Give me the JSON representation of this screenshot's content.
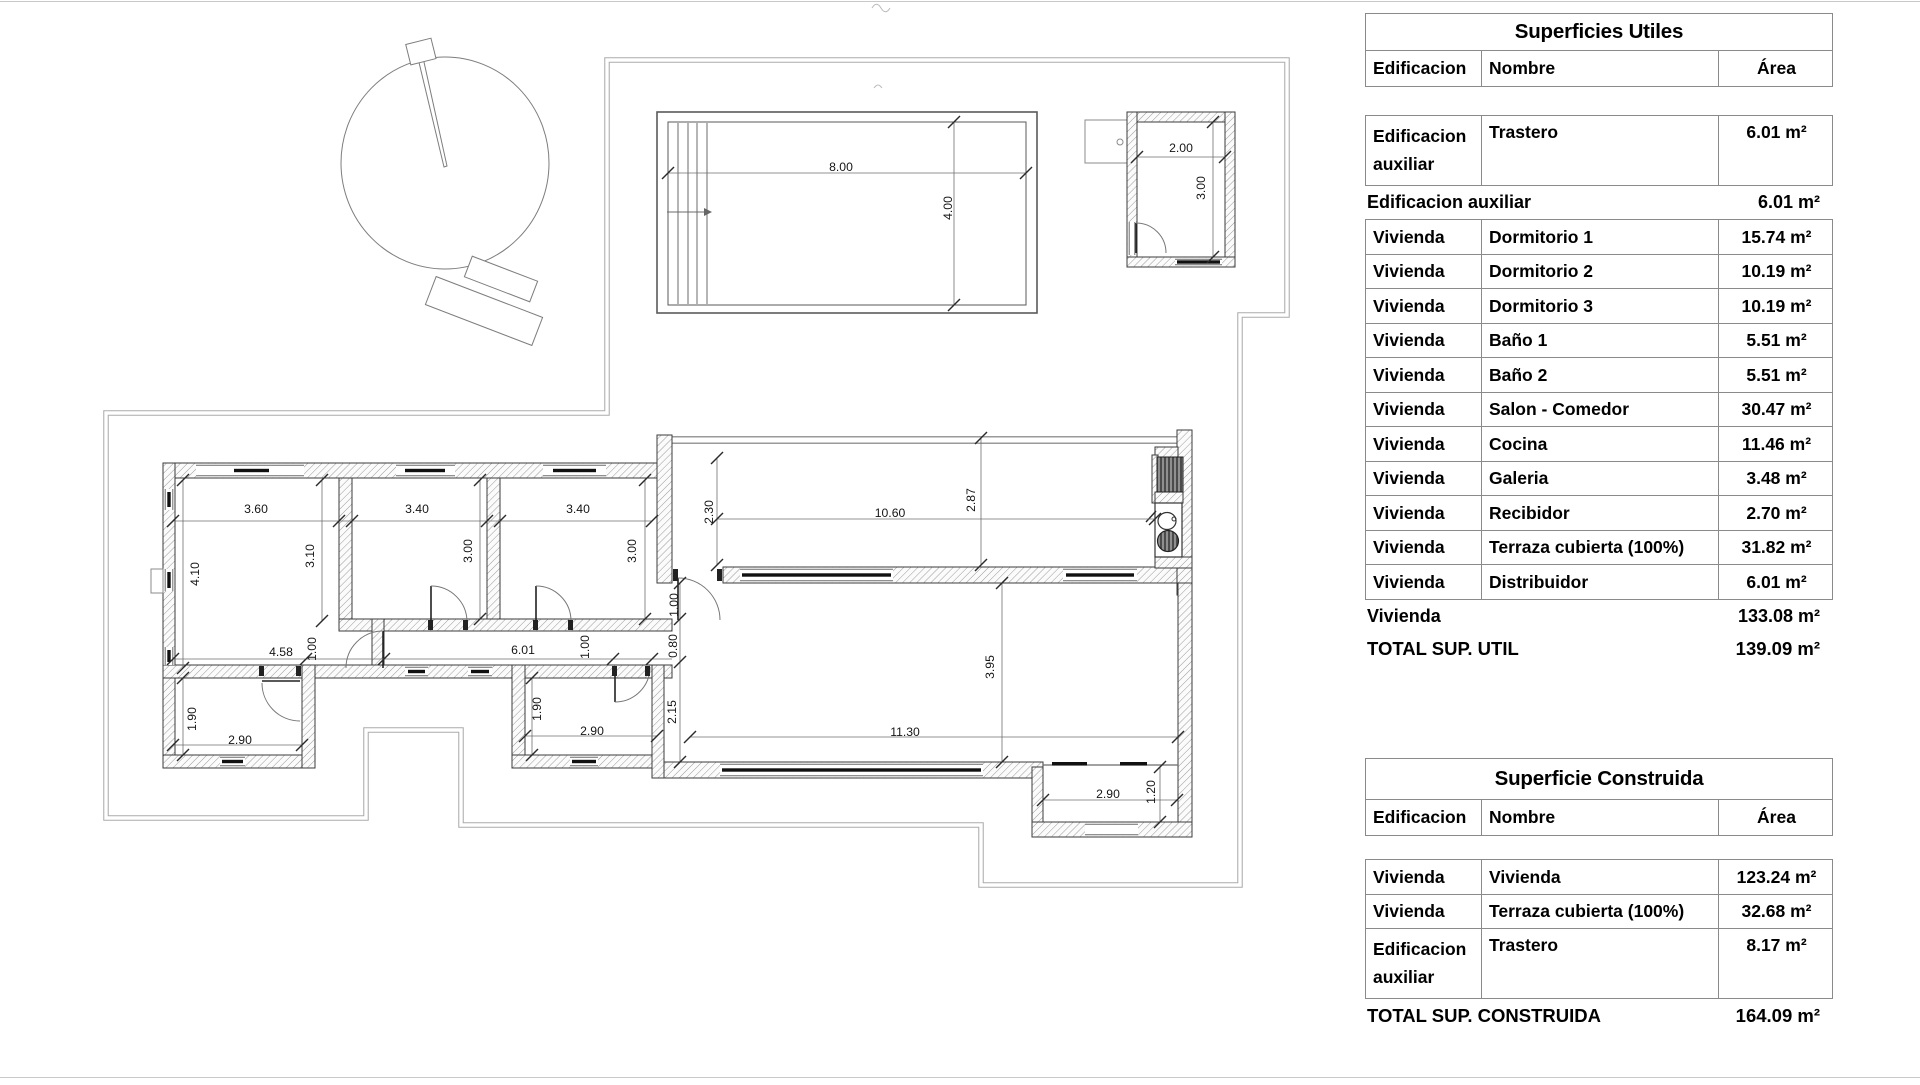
{
  "plan": {
    "dimensions": [
      {
        "text": "8.00",
        "x": 841,
        "y": 167
      },
      {
        "text": "4.00",
        "x": 948,
        "y": 208,
        "rot": true
      },
      {
        "text": "2.00",
        "x": 1181,
        "y": 148
      },
      {
        "text": "3.00",
        "x": 1201,
        "y": 188,
        "rot": true
      },
      {
        "text": "3.60",
        "x": 256,
        "y": 509
      },
      {
        "text": "3.40",
        "x": 417,
        "y": 509
      },
      {
        "text": "3.40",
        "x": 578,
        "y": 509
      },
      {
        "text": "4.10",
        "x": 195,
        "y": 574,
        "rot": true
      },
      {
        "text": "3.10",
        "x": 310,
        "y": 556,
        "rot": true
      },
      {
        "text": "3.00",
        "x": 468,
        "y": 551,
        "rot": true
      },
      {
        "text": "3.00",
        "x": 632,
        "y": 551,
        "rot": true
      },
      {
        "text": "4.58",
        "x": 281,
        "y": 652
      },
      {
        "text": "1.00",
        "x": 312,
        "y": 649,
        "rot": true
      },
      {
        "text": "6.01",
        "x": 523,
        "y": 650
      },
      {
        "text": "1.00",
        "x": 585,
        "y": 647,
        "rot": true
      },
      {
        "text": "1.00",
        "x": 674,
        "y": 605,
        "rot": true
      },
      {
        "text": "0.80",
        "x": 673,
        "y": 646,
        "rot": true
      },
      {
        "text": "2.15",
        "x": 672,
        "y": 712,
        "rot": true
      },
      {
        "text": "1.90",
        "x": 192,
        "y": 719,
        "rot": true
      },
      {
        "text": "2.90",
        "x": 240,
        "y": 740
      },
      {
        "text": "1.90",
        "x": 537,
        "y": 709,
        "rot": true
      },
      {
        "text": "2.90",
        "x": 592,
        "y": 731
      },
      {
        "text": "2.30",
        "x": 709,
        "y": 512,
        "rot": true
      },
      {
        "text": "10.60",
        "x": 890,
        "y": 513
      },
      {
        "text": "2.87",
        "x": 971,
        "y": 500,
        "rot": true
      },
      {
        "text": "3.95",
        "x": 990,
        "y": 667,
        "rot": true
      },
      {
        "text": "11.30",
        "x": 905,
        "y": 732
      },
      {
        "text": "2.90",
        "x": 1108,
        "y": 794
      },
      {
        "text": "1.20",
        "x": 1151,
        "y": 792,
        "rot": true
      }
    ]
  },
  "tables": {
    "superficies_utiles": {
      "title": "Superficies Utiles",
      "headers": [
        "Edificacion",
        "Nombre",
        "Área"
      ],
      "entries": [
        {
          "kind": "row",
          "tall": true,
          "edificacion": "Edificacion auxiliar",
          "nombre": "Trastero",
          "area": "6.01 m²"
        },
        {
          "kind": "group_total",
          "label": "Edificacion auxiliar",
          "value": "6.01 m²"
        },
        {
          "kind": "row",
          "edificacion": "Vivienda",
          "nombre": "Dormitorio 1",
          "area": "15.74 m²"
        },
        {
          "kind": "row",
          "edificacion": "Vivienda",
          "nombre": "Dormitorio 2",
          "area": "10.19 m²"
        },
        {
          "kind": "row",
          "edificacion": "Vivienda",
          "nombre": "Dormitorio 3",
          "area": "10.19 m²"
        },
        {
          "kind": "row",
          "edificacion": "Vivienda",
          "nombre": "Baño 1",
          "area": "5.51 m²"
        },
        {
          "kind": "row",
          "edificacion": "Vivienda",
          "nombre": "Baño 2",
          "area": "5.51 m²"
        },
        {
          "kind": "row",
          "edificacion": "Vivienda",
          "nombre": "Salon - Comedor",
          "area": "30.47 m²"
        },
        {
          "kind": "row",
          "edificacion": "Vivienda",
          "nombre": "Cocina",
          "area": "11.46 m²"
        },
        {
          "kind": "row",
          "edificacion": "Vivienda",
          "nombre": "Galeria",
          "area": "3.48 m²"
        },
        {
          "kind": "row",
          "edificacion": "Vivienda",
          "nombre": "Recibidor",
          "area": "2.70 m²"
        },
        {
          "kind": "row",
          "edificacion": "Vivienda",
          "nombre": "Terraza cubierta (100%)",
          "area": "31.82 m²"
        },
        {
          "kind": "row",
          "edificacion": "Vivienda",
          "nombre": "Distribuidor",
          "area": "6.01 m²"
        },
        {
          "kind": "group_total",
          "label": "Vivienda",
          "value": "133.08 m²"
        },
        {
          "kind": "grand_total",
          "label": "TOTAL SUP. UTIL",
          "value": "139.09 m²"
        }
      ]
    },
    "superficie_construida": {
      "title": "Superficie Construida",
      "headers": [
        "Edificacion",
        "Nombre",
        "Área"
      ],
      "entries": [
        {
          "kind": "row",
          "edificacion": "Vivienda",
          "nombre": "Vivienda",
          "area": "123.24 m²"
        },
        {
          "kind": "row",
          "edificacion": "Vivienda",
          "nombre": "Terraza cubierta (100%)",
          "area": "32.68 m²"
        },
        {
          "kind": "row",
          "tall": true,
          "edificacion": "Edificacion auxiliar",
          "nombre": "Trastero",
          "area": "8.17 m²"
        },
        {
          "kind": "grand_total",
          "label": "TOTAL SUP. CONSTRUIDA",
          "value": "164.09 m²"
        }
      ]
    }
  }
}
